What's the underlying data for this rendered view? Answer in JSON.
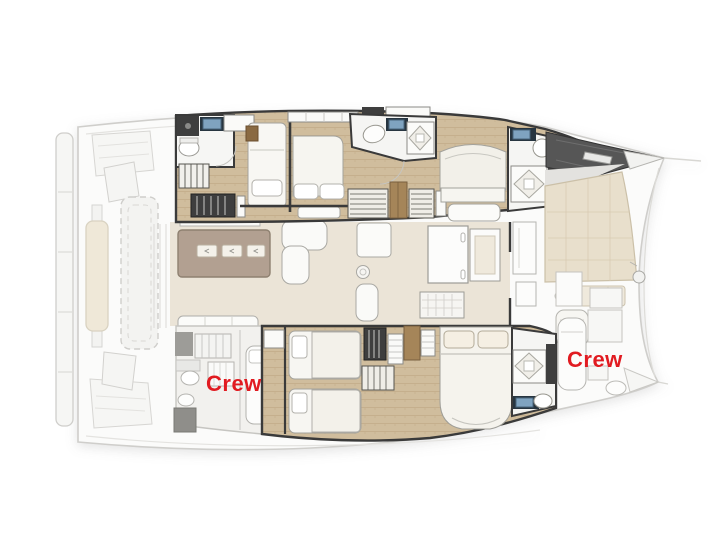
{
  "plan": {
    "labels": {
      "crew_aft": "Crew",
      "crew_forward": "Crew"
    },
    "colors": {
      "label_red": "#e11b21",
      "background": "#ffffff",
      "wood_floor": "#d0bd9d",
      "salon_floor": "#ebe4d7",
      "galley_island_taupe": "#b2a091",
      "dark_walls": "#3a3a3a",
      "dark_fixture": "#3e3e3e",
      "faded_outline": "#cfcecb",
      "sunpad_beige": "#e8dfcc",
      "sink_blue": "#7fa3c0",
      "white_furniture": "#f8f7f3"
    }
  }
}
